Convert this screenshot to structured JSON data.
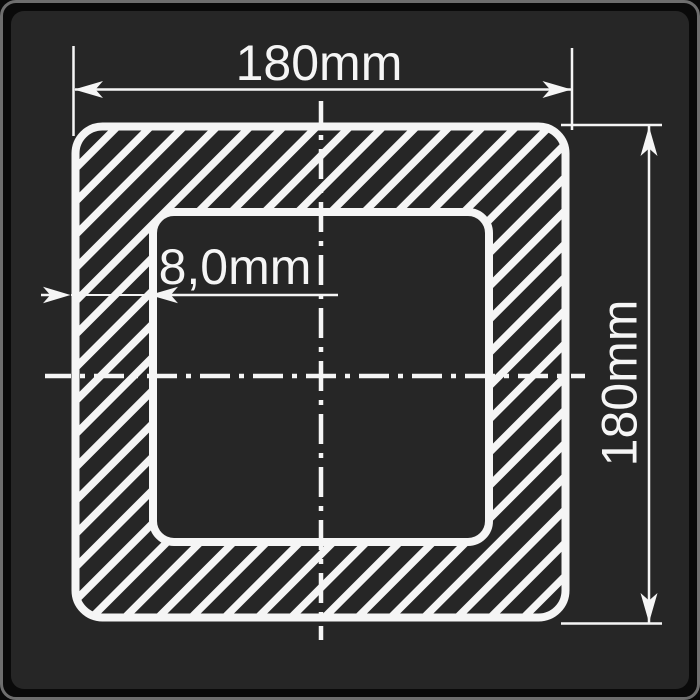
{
  "colors": {
    "canvas": "#0a0a0a",
    "frame-border": "#6e6e6e",
    "panel": "#262626",
    "line": "#f5f5f5"
  },
  "drawing": {
    "dimensions": {
      "width": {
        "label": "180mm"
      },
      "height": {
        "label": "180mm"
      },
      "wall_thickness": {
        "label": "8,0mm"
      }
    }
  }
}
